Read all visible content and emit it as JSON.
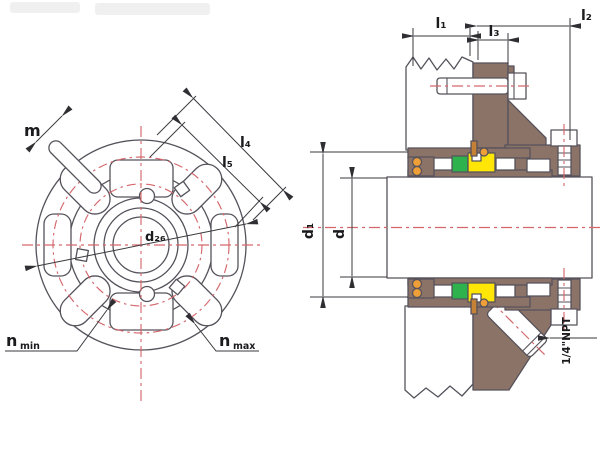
{
  "front_view": {
    "labels": {
      "m": "m",
      "l4": "l₄",
      "l5": "l₅",
      "d26": "d₂₆",
      "n_min": {
        "base": "n",
        "sub": "min"
      },
      "n_max": {
        "base": "n",
        "sub": "max"
      }
    }
  },
  "section_view": {
    "labels": {
      "l1": "l₁",
      "l2": "l₂",
      "l3": "l₃",
      "d1": "d₁",
      "d": "d",
      "port": "1/4\"NPT"
    }
  },
  "colors": {
    "brown": "#8B7368",
    "green": "#2EB24D",
    "yellow": "#FFE606",
    "orange": "#EF9F38",
    "pin": "#C58136",
    "red": "#D4676C",
    "line": "#56525B",
    "dim": "#3A3A3F"
  }
}
